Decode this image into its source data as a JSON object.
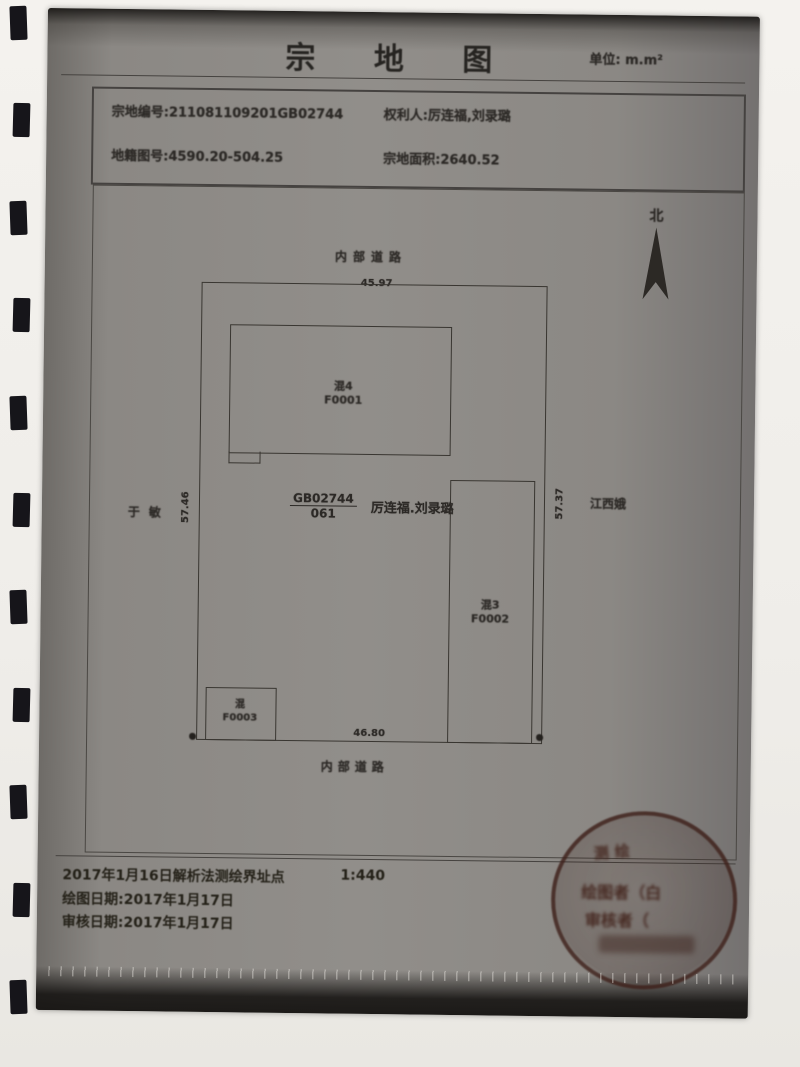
{
  "header": {
    "title": "宗 地 图",
    "unit": "单位: m.m²"
  },
  "info_box": {
    "parcel_no": "宗地编号:211081109201GB02744",
    "rights_holder": "权利人:厉连福,刘录璐",
    "sheet_no": "地籍图号:4590.20-504.25",
    "area": "宗地面积:2640.52"
  },
  "map": {
    "north_label": "北",
    "road_top": "内部道路",
    "road_bottom": "内部道路",
    "dim_top": "45.97",
    "dim_bottom": "46.80",
    "dim_left": "57.46",
    "dim_right": "57.37",
    "neighbor_left": "于敏",
    "neighbor_right": "江西娥",
    "parcel_label": {
      "numerator": "GB02744",
      "denominator": "061",
      "holders": "厉连福.刘录璐"
    },
    "buildings": [
      {
        "type": "混4",
        "code": "F0001"
      },
      {
        "type": "混3",
        "code": "F0002"
      },
      {
        "type": "混",
        "code": "F0003"
      }
    ]
  },
  "footer": {
    "survey_line": "2017年1月16日解析法测绘界址点",
    "scale": "1:440",
    "draw_date": "绘图日期:2017年1月17日",
    "review_date": "审核日期:2017年1月17日",
    "stamp": {
      "arc_fragment": "测绘",
      "fragment1": "绘图者（白",
      "fragment2": "审核者（"
    }
  }
}
